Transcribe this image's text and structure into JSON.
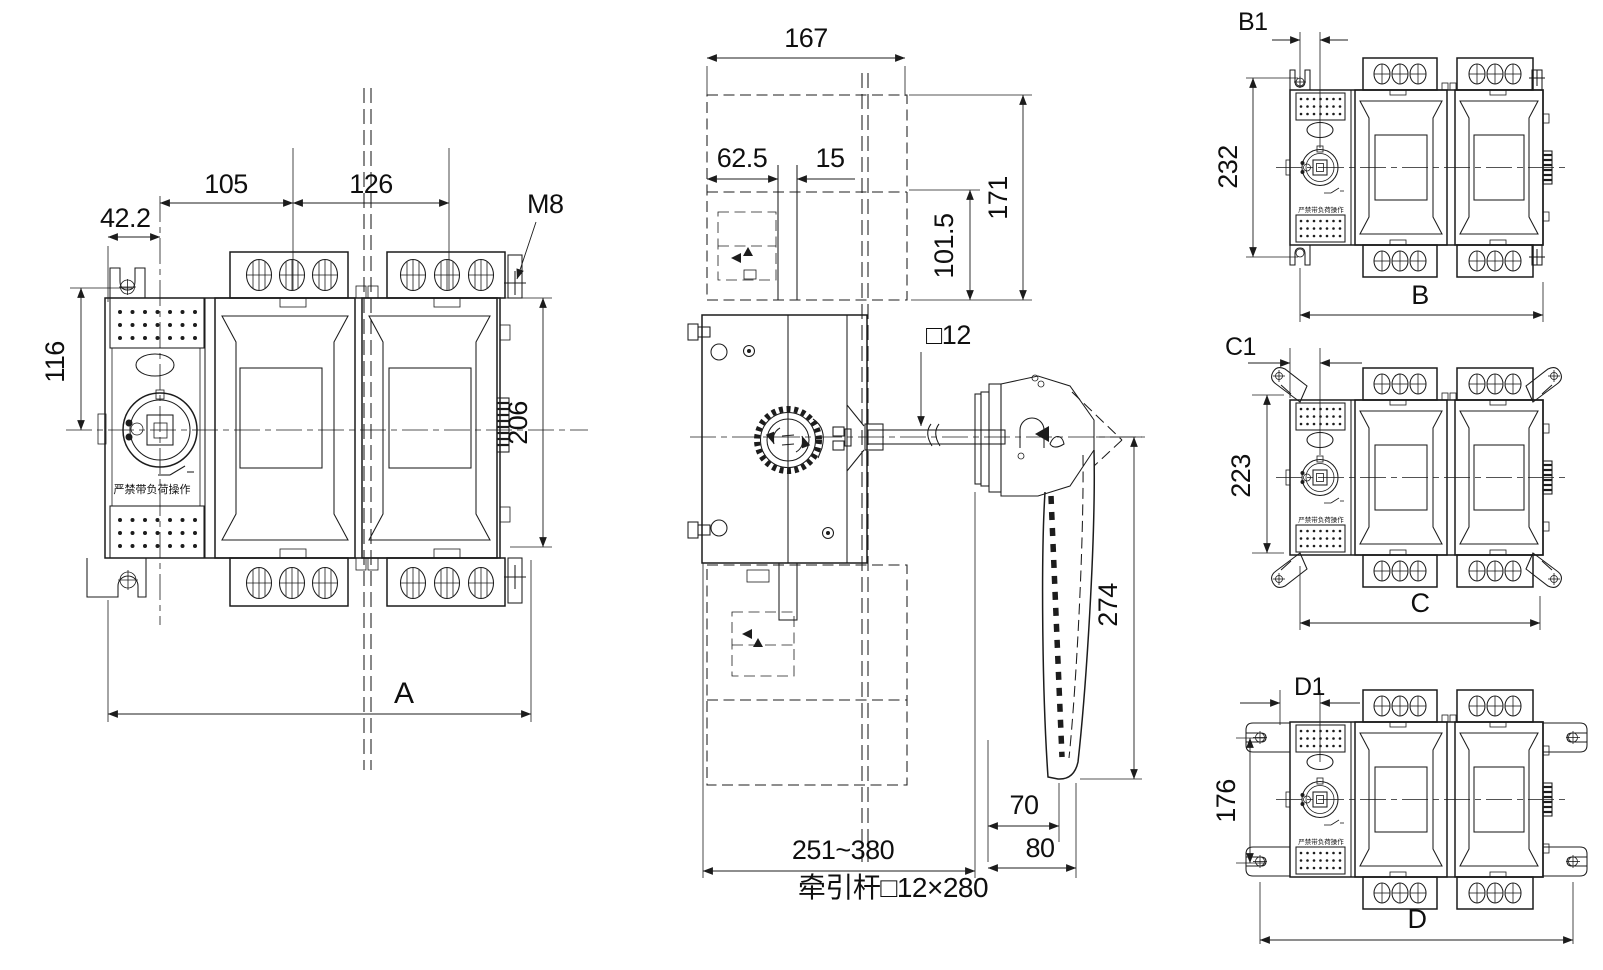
{
  "colors": {
    "line": "#1c1c1c",
    "background": "#ffffff",
    "text": "#0f0f0f"
  },
  "front_view": {
    "warning_label": "严禁带负荷操作",
    "dims": {
      "bracket_offset": "42.2",
      "pole_pitch_left": "105",
      "pole_pitch_right": "126",
      "terminal_thread": "M8",
      "mount_to_center": "116",
      "body_height": "206",
      "overall_width": "A"
    }
  },
  "side_view": {
    "caption": "牵引杆□12×280",
    "dims": {
      "depth_top": "167",
      "front_offset": "62.5",
      "rail_gap": "15",
      "upper_height": "171",
      "lower_height": "101.5",
      "shaft_section": "□12",
      "handle_length": "274",
      "grip_width": "70",
      "handle_depth": "80",
      "depth_range": "251~380"
    }
  },
  "variant_views": [
    {
      "offset_label": "B1",
      "height_label": "232",
      "width_label": "B"
    },
    {
      "offset_label": "C1",
      "height_label": "223",
      "width_label": "C"
    },
    {
      "offset_label": "D1",
      "height_label": "176",
      "width_label": "D"
    }
  ]
}
